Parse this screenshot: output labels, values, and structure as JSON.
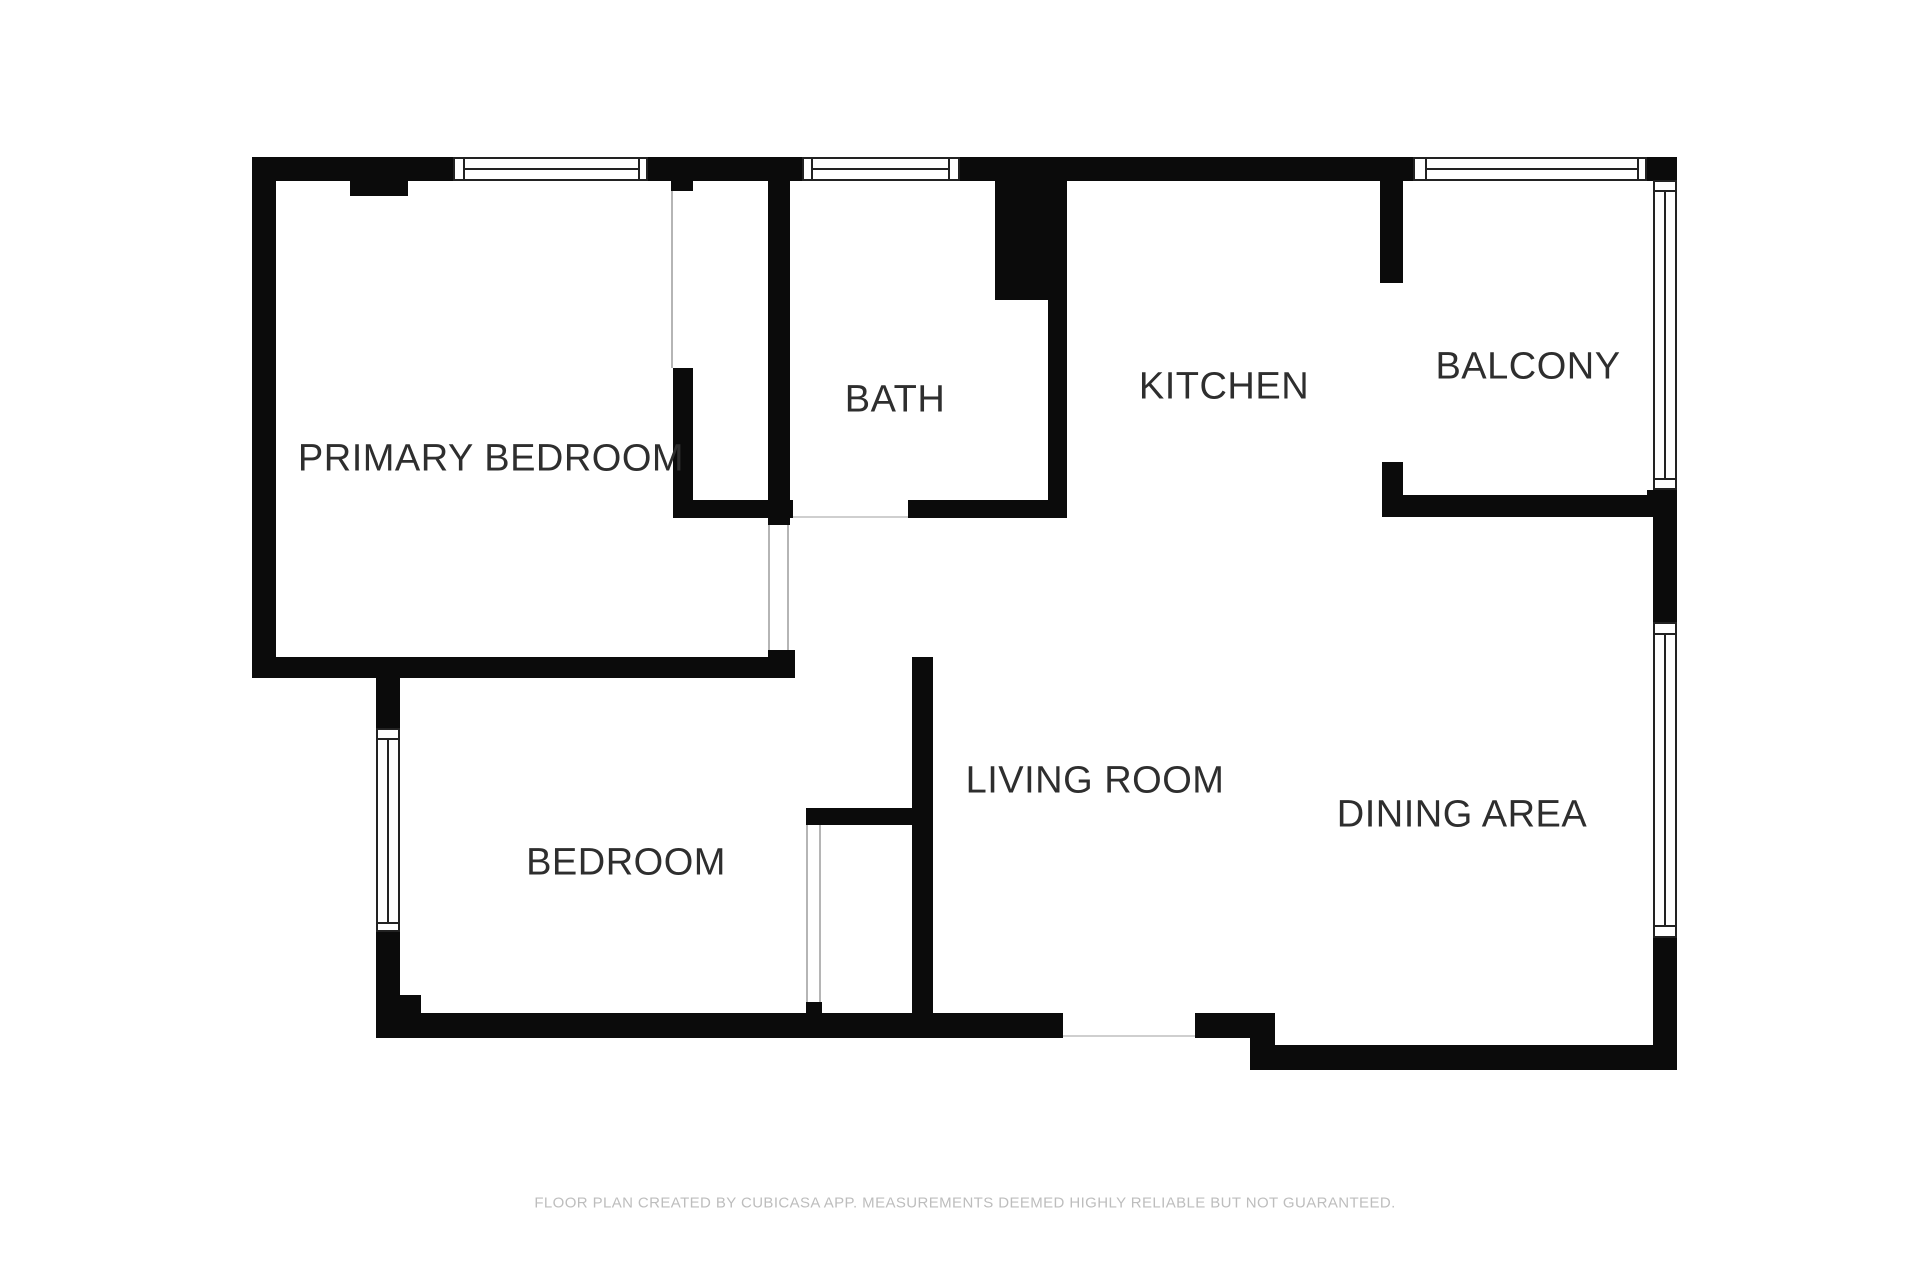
{
  "colors": {
    "wall": "#0b0b0b",
    "window_line": "#222222",
    "opening_line": "#b5b5b5",
    "threshold_line": "#cfcfcf",
    "label": "#2e2e2e",
    "footer": "#bdbdbd",
    "background": "#ffffff"
  },
  "rooms": [
    {
      "label": "PRIMARY BEDROOM"
    },
    {
      "label": "BEDROOM"
    },
    {
      "label": "BATH"
    },
    {
      "label": "KITCHEN"
    },
    {
      "label": "BALCONY"
    },
    {
      "label": "LIVING ROOM"
    },
    {
      "label": "DINING AREA"
    }
  ],
  "footer": {
    "text": "FLOOR PLAN CREATED BY CUBICASA APP. MEASUREMENTS DEEMED HIGHLY RELIABLE BUT NOT GUARANTEED."
  }
}
